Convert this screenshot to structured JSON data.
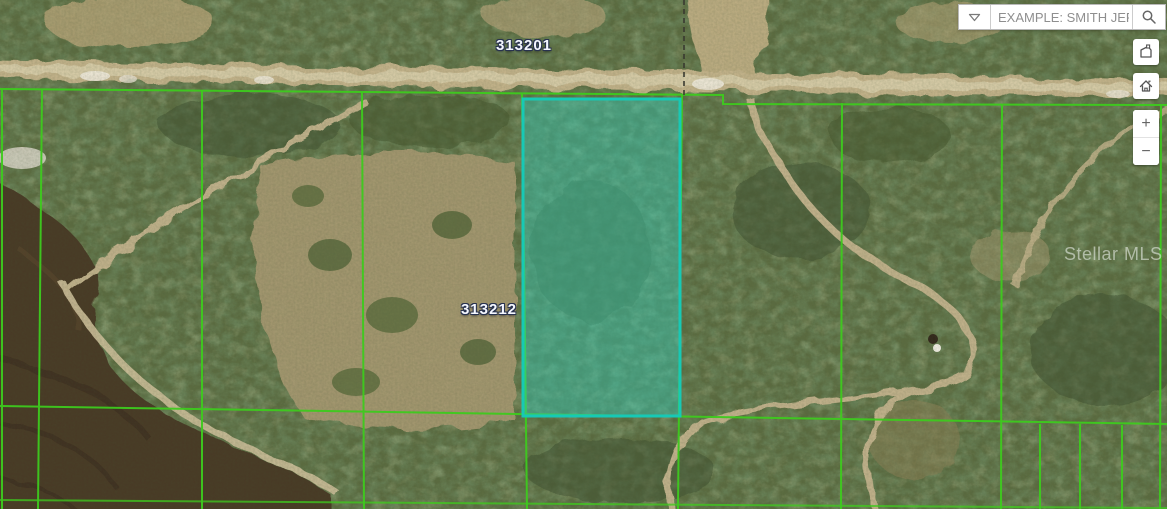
{
  "map": {
    "type": "aerial-parcel-map",
    "parcel_labels": [
      {
        "id": "313201"
      },
      {
        "id": "313212"
      }
    ],
    "watermark": "Stellar MLS",
    "colors": {
      "parcel_line": "#3ecb1e",
      "selected_parcel_border": "#17c9b5",
      "selected_parcel_fill": "rgba(45,212,195,0.40)"
    }
  },
  "search": {
    "placeholder": "EXAMPLE: SMITH JER...",
    "value": "",
    "icons": {
      "dropdown": "chevron-down-icon",
      "submit": "magnifier-icon"
    }
  },
  "controls": {
    "measure": {
      "icon": "polygon-icon"
    },
    "home": {
      "icon": "home-icon"
    },
    "zoom_in_label": "+",
    "zoom_out_label": "−"
  }
}
